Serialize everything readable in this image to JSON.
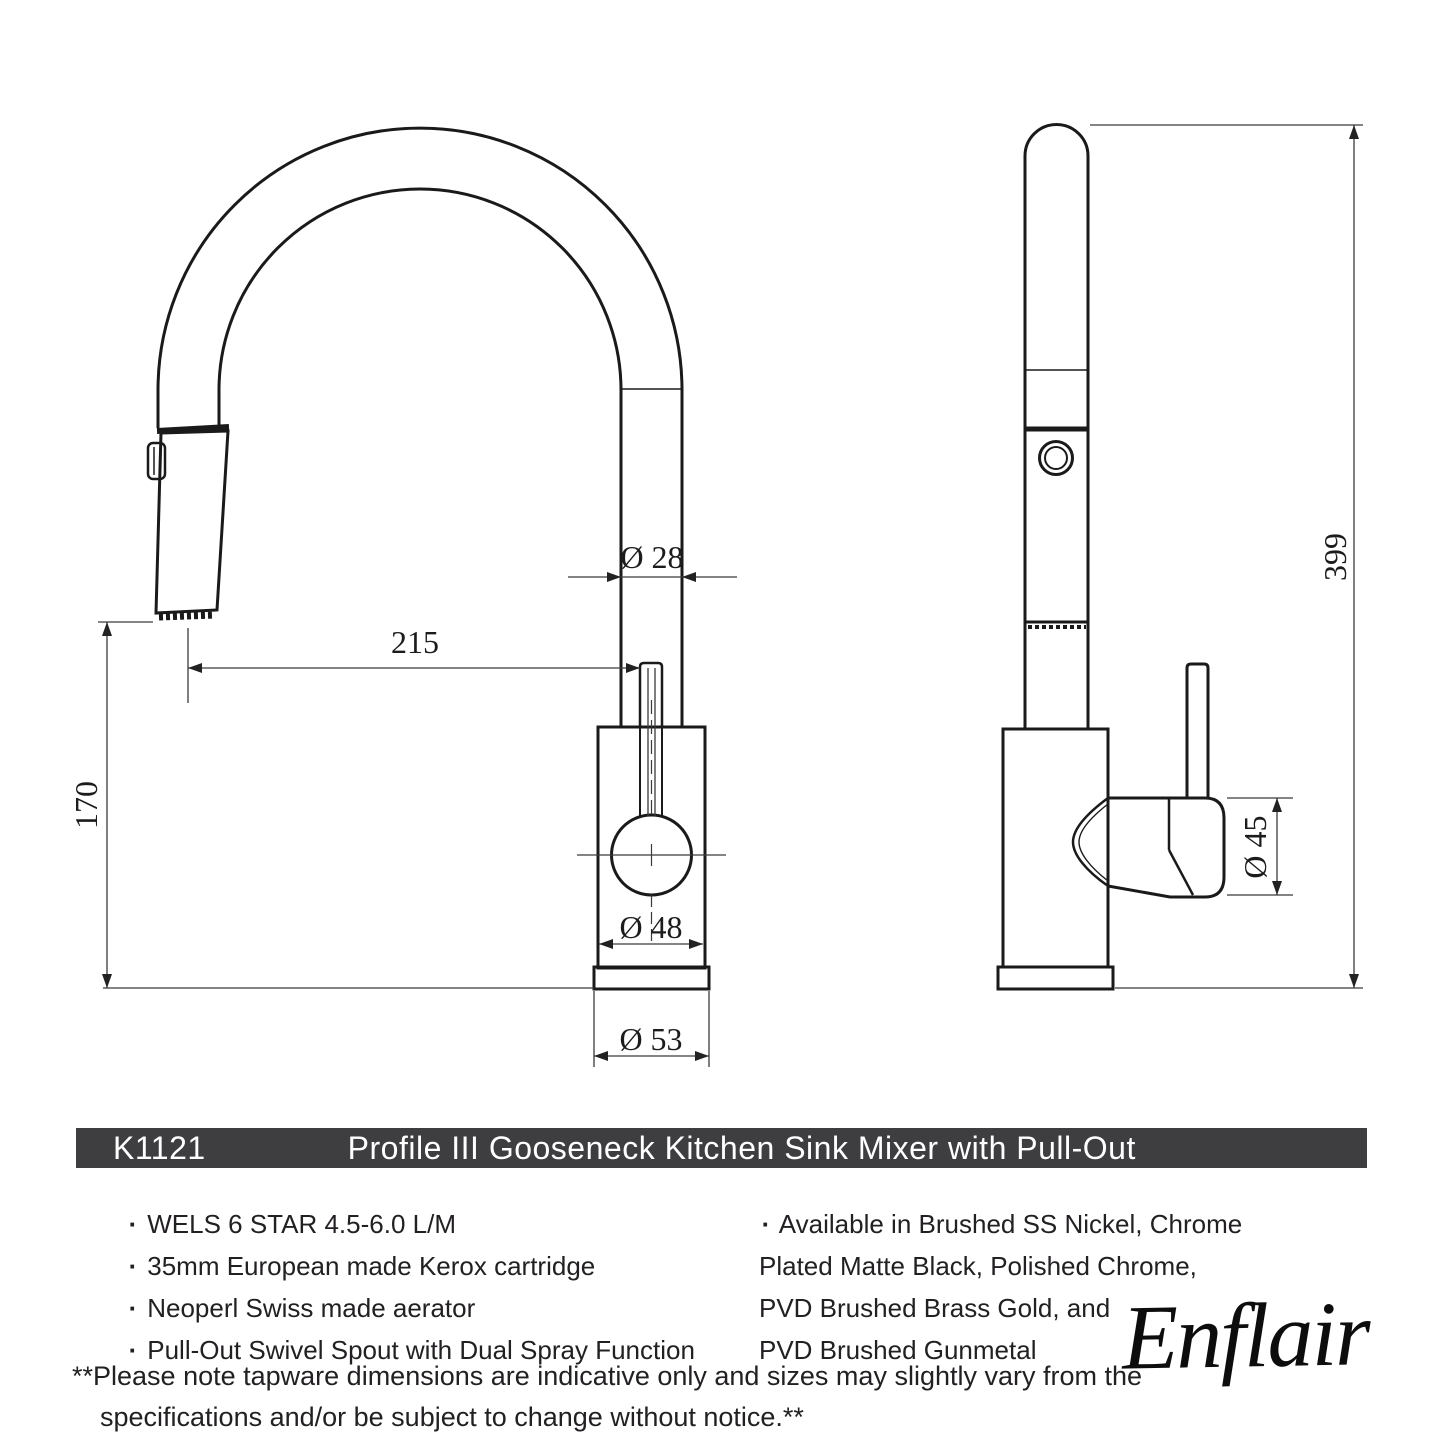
{
  "title_bar": {
    "code": "K1121",
    "title": "Profile III Gooseneck Kitchen Sink Mixer with Pull-Out"
  },
  "drawing": {
    "dims": {
      "spout_tube_diameter": "Ø 28",
      "spout_reach": "215",
      "outlet_height": "170",
      "body_diameter": "Ø 48",
      "base_diameter": "Ø 53",
      "total_height": "399",
      "handle_diameter": "Ø 45"
    }
  },
  "ui": {
    "bullet": "·"
  },
  "features": [
    "WELS 6 STAR 4.5-6.0 L/M",
    "35mm European made Kerox cartridge",
    "Neoperl Swiss made aerator",
    "Pull-Out Swivel Spout with Dual Spray Function"
  ],
  "finishes_lines": [
    "Available in Brushed SS Nickel, Chrome",
    "Plated Matte Black, Polished Chrome,",
    "PVD Brushed Brass Gold, and",
    "PVD Brushed Gunmetal"
  ],
  "footnote_lines": [
    "**Please note tapware dimensions are indicative only and sizes may slightly vary from the",
    "specifications and/or be subject to change without notice.**"
  ],
  "brand": "Enflair",
  "colors": {
    "bar_bg": "#3e3d40",
    "bar_text": "#ffffff",
    "line": "#1a1a1a",
    "dim_line": "#3a3a3a"
  }
}
